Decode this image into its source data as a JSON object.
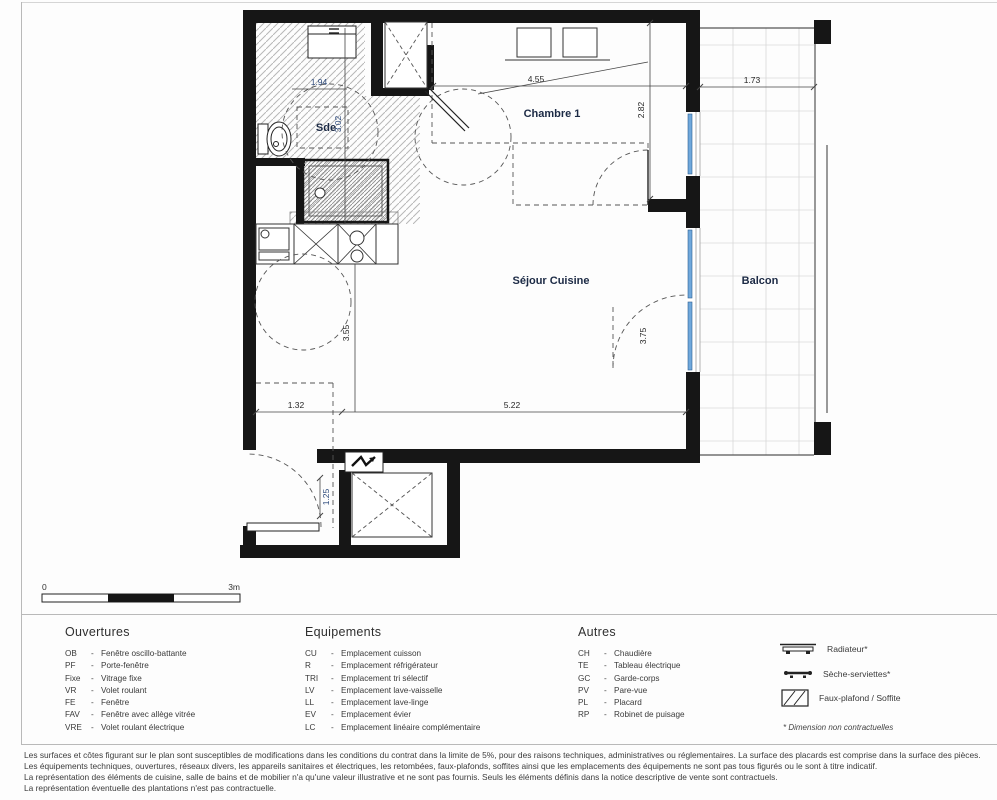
{
  "plan": {
    "rooms": {
      "sde": "Sde",
      "chambre1": "Chambre 1",
      "sejour_cuisine": "Séjour Cuisine",
      "balcon": "Balcon"
    },
    "dims": {
      "sde_width": "1.94",
      "sde_depth": "3.02",
      "chambre_width": "4.55",
      "chambre_depth": "2.82",
      "balcon_width": "1.73",
      "kitchen_depth": "3.55",
      "porte_fenetre": "3.75",
      "entry_width": "1.32",
      "sejour_width": "5.22",
      "entry_depth": "1.25"
    },
    "scalebar": {
      "zero": "0",
      "max": "3m"
    }
  },
  "legend": {
    "dash": "-",
    "ouvertures": {
      "title": "Ouvertures",
      "items": [
        {
          "abbr": "OB",
          "label": "Fenêtre oscillo-battante"
        },
        {
          "abbr": "PF",
          "label": "Porte-fenêtre"
        },
        {
          "abbr": "Fixe",
          "label": "Vitrage fixe"
        },
        {
          "abbr": "VR",
          "label": "Volet roulant"
        },
        {
          "abbr": "FE",
          "label": "Fenêtre"
        },
        {
          "abbr": "FAV",
          "label": "Fenêtre avec allège vitrée"
        },
        {
          "abbr": "VRE",
          "label": "Volet roulant électrique"
        }
      ]
    },
    "equipements": {
      "title": "Equipements",
      "items": [
        {
          "abbr": "CU",
          "label": "Emplacement cuisson"
        },
        {
          "abbr": "R",
          "label": "Emplacement réfrigérateur"
        },
        {
          "abbr": "TRI",
          "label": "Emplacement tri sélectif"
        },
        {
          "abbr": "LV",
          "label": "Emplacement lave-vaisselle"
        },
        {
          "abbr": "LL",
          "label": "Emplacement lave-linge"
        },
        {
          "abbr": "EV",
          "label": "Emplacement évier"
        },
        {
          "abbr": "LC",
          "label": "Emplacement linéaire complémentaire"
        }
      ]
    },
    "autres": {
      "title": "Autres",
      "items": [
        {
          "abbr": "CH",
          "label": "Chaudière"
        },
        {
          "abbr": "TE",
          "label": "Tableau électrique"
        },
        {
          "abbr": "GC",
          "label": "Garde-corps"
        },
        {
          "abbr": "PV",
          "label": "Pare-vue"
        },
        {
          "abbr": "PL",
          "label": "Placard"
        },
        {
          "abbr": "RP",
          "label": "Robinet de puisage"
        }
      ]
    },
    "symbols": {
      "radiateur": "Radiateur*",
      "seche_serviettes": "Sèche-serviettes*",
      "faux_plafond": "Faux-plafond / Soffite"
    },
    "note": "* Dimension non contractuelles"
  },
  "disclaimer": {
    "lines": [
      "Les surfaces et côtes figurant sur le plan sont susceptibles de modifications dans les conditions du contrat dans la limite de 5%, pour des raisons techniques, administratives ou réglementaires. La surface des placards est comprise dans la surface des pièces.",
      "Les équipements techniques, ouvertures, réseaux divers, les appareils sanitaires et électriques, les retombées, faux-plafonds, soffites ainsi que les emplacements des équipements ne sont pas tous figurés ou le sont à titre indicatif.",
      "La représentation des éléments de cuisine, salle de bains et de mobilier n'a qu'une valeur illustrative et ne sont pas fournis. Seuls les éléments définis dans la notice descriptive de vente sont contractuels.",
      "La représentation éventuelle des plantations n'est pas contractuelle."
    ]
  },
  "colors": {
    "wall": "#161616",
    "glazing": "#6fa8dc",
    "room_label": "#1c2a45",
    "dim_blue": "#2d4a7c"
  }
}
